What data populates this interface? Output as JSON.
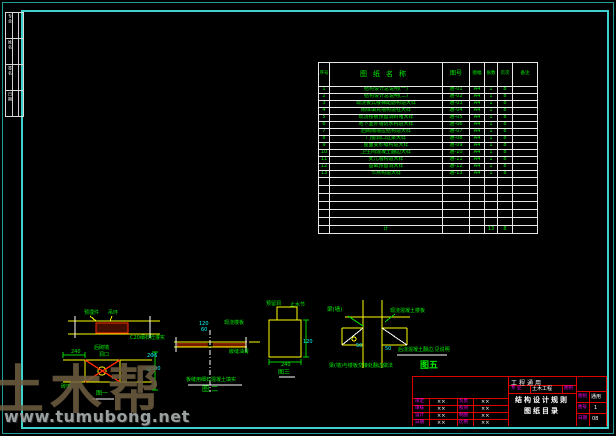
{
  "colors": {
    "background": "#000000",
    "frame_teal": "#3fd2cd",
    "table_line": "#e8e8e8",
    "text_green": "#00ef00",
    "text_cyan": "#00ffff",
    "text_magenta": "#ff00ff",
    "line_yellow": "#ffff00",
    "line_red": "#ff2a00",
    "titleblock_red": "#e00000",
    "watermark_brown": "#705e42",
    "watermark_gray": "#9aa0a0"
  },
  "watermark": {
    "brand": "土木帮",
    "url": "www.tumubong.net"
  },
  "signoff": {
    "blocks": [
      {
        "label": "专业"
      },
      {
        "label": "姓名"
      },
      {
        "label": "签名"
      },
      {
        "label": "日期"
      }
    ]
  },
  "drawing_list": {
    "headers": {
      "index": "序号",
      "name": "图纸名称",
      "number": "图号",
      "size": "图幅",
      "sheets": "张数",
      "page": "页次",
      "note": "备注"
    },
    "rows": [
      {
        "index": "1",
        "name": "结构设计总说明(一)",
        "number": "通-01",
        "size": "A4",
        "sheets": "1",
        "page": "8"
      },
      {
        "index": "2",
        "name": "结构设计总说明(二)",
        "number": "通-02",
        "size": "A4",
        "sheets": "1",
        "page": "8"
      },
      {
        "index": "3",
        "name": "现浇板式楼梯配筋构造大样",
        "number": "通-03",
        "size": "A4",
        "sheets": "1",
        "page": "8"
      },
      {
        "index": "4",
        "name": "砌体填充墙构造柱大样",
        "number": "通-04",
        "size": "A4",
        "sheets": "1",
        "page": "8"
      },
      {
        "index": "5",
        "name": "现浇楼板预留洞封堵大样",
        "number": "通-05",
        "size": "A4",
        "sheets": "1",
        "page": "8"
      },
      {
        "index": "6",
        "name": "地下室外墙防水构造大样",
        "number": "通-06",
        "size": "A4",
        "sheets": "1",
        "page": "8"
      },
      {
        "index": "7",
        "name": "后砌隔墙拉结构造大样",
        "number": "通-07",
        "size": "A4",
        "sheets": "1",
        "page": "8"
      },
      {
        "index": "8",
        "name": "门窗洞口过梁大样",
        "number": "通-08",
        "size": "A4",
        "sheets": "1",
        "page": "8"
      },
      {
        "index": "9",
        "name": "屋面变形缝构造大样",
        "number": "通-09",
        "size": "A4",
        "sheets": "1",
        "page": "8"
      },
      {
        "index": "10",
        "name": "卫生间混凝土翻边大样",
        "number": "通-10",
        "size": "A4",
        "sheets": "1",
        "page": "8"
      },
      {
        "index": "11",
        "name": "女儿墙构造大样",
        "number": "通-11",
        "size": "A4",
        "sheets": "1",
        "page": "8"
      },
      {
        "index": "12",
        "name": "基础预留洞大样",
        "number": "通-12",
        "size": "A4",
        "sheets": "1",
        "page": "8"
      },
      {
        "index": "13",
        "name": "节点构造大样",
        "number": "通-13",
        "size": "A4",
        "sheets": "1",
        "page": "8"
      }
    ],
    "empty_row_count": 6,
    "total": {
      "label": "计",
      "sheets": "13",
      "page": "8"
    }
  },
  "figures": {
    "fig_embed": {
      "label_a": "预埋件",
      "label_b": "吊环",
      "label_c": "C20细石砼灌实"
    },
    "fig1": {
      "dim": "240",
      "label_a": "后砌墙",
      "label_b": "洞口",
      "label_c": "砖墙",
      "cyan_a": "2Φ6",
      "cyan_b": "@500",
      "caption": "图一"
    },
    "fig2": {
      "cyan_a": "120",
      "cyan_b": "60",
      "label_a": "现浇楼板",
      "label_b": "嵌缝油膏",
      "note": "板缝用细石混凝土填实",
      "caption": "图 二"
    },
    "fig3": {
      "label_a": "预留洞",
      "label_b": "止水节",
      "cyan": "120",
      "dim": "240",
      "caption": "图三"
    },
    "fig5": {
      "label_a": "梁(墙)",
      "label_b": "现浇混凝土楼板",
      "label_c": "后浇混凝土翻边,见说明",
      "dim_a": "50",
      "dim_b": "50",
      "note": "梁(墙)与楼板交接处翻边做法",
      "caption": "图五"
    }
  },
  "title_block": {
    "project": "工程通用",
    "major_label": "专 业",
    "major_value": "土木工程",
    "category_label": "图别",
    "title_line1": "结构设计规则",
    "title_line2": "图纸目录",
    "info": [
      {
        "label": "图别",
        "value": "通用"
      },
      {
        "label": "图号",
        "value": "1"
      },
      {
        "label": "日期",
        "value": "08"
      }
    ],
    "signatures": [
      {
        "l1": "审定",
        "v1": "××",
        "l2": "负责",
        "v2": "××"
      },
      {
        "l1": "审核",
        "v1": "××",
        "l2": "校对",
        "v2": "××"
      },
      {
        "l1": "设计",
        "v1": "××",
        "l2": "制图",
        "v2": "××"
      },
      {
        "l1": "日期",
        "v1": "××",
        "l2": "比例",
        "v2": "××"
      }
    ]
  }
}
